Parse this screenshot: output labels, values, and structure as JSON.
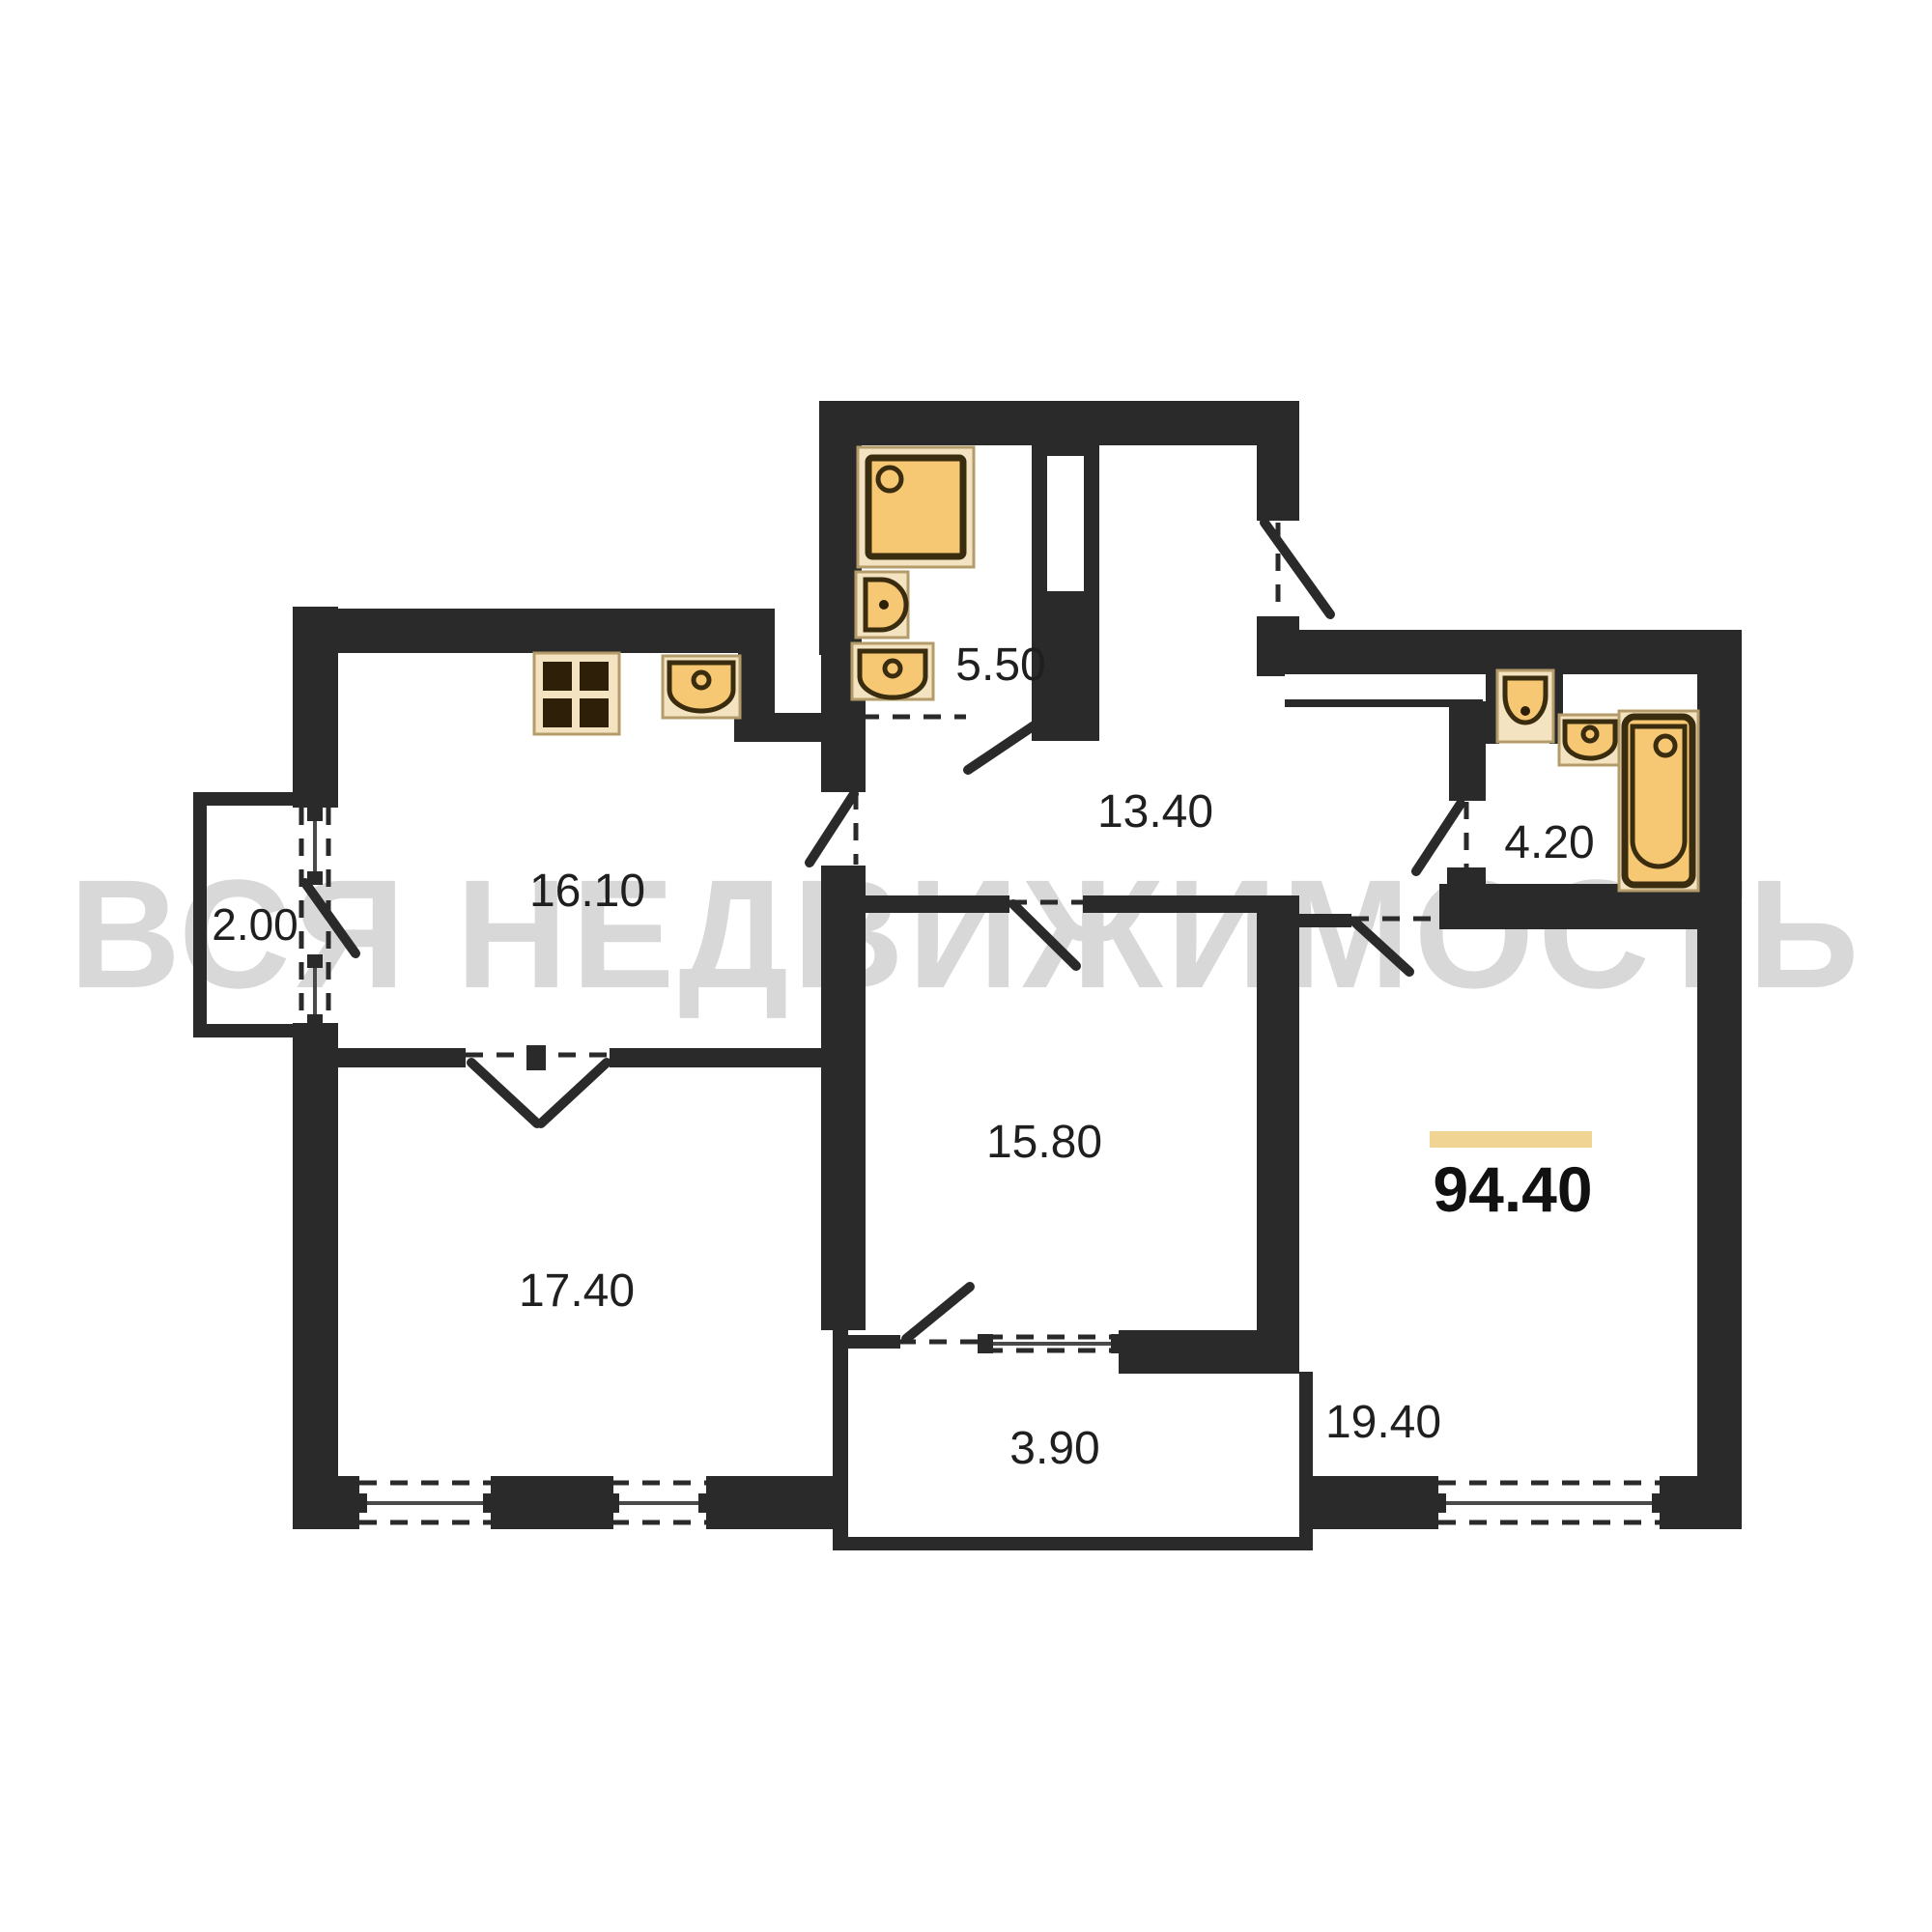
{
  "watermark": {
    "text": "ВСЯ НЕДВИЖИМОСТЬ",
    "color": "#d8d8d8"
  },
  "total": {
    "area": "94.40",
    "underline_color": "#f0d494"
  },
  "rooms": [
    {
      "name": "balcony-left",
      "area": "2.00"
    },
    {
      "name": "kitchen",
      "area": "16.10"
    },
    {
      "name": "bathroom-top",
      "area": "5.50"
    },
    {
      "name": "hallway",
      "area": "13.40"
    },
    {
      "name": "bathroom-right",
      "area": "4.20"
    },
    {
      "name": "room-bottom-left",
      "area": "17.40"
    },
    {
      "name": "room-middle",
      "area": "15.80"
    },
    {
      "name": "loggia-bottom",
      "area": "3.90"
    },
    {
      "name": "room-bottom-right",
      "area": "19.40"
    }
  ],
  "fixtures": [
    "shower-tray",
    "toilet",
    "wash-basin",
    "kitchen-sink",
    "stove",
    "toilet",
    "wash-basin",
    "bathtub"
  ],
  "colors": {
    "wall": "#2a2a2a",
    "fixture_fill": "#f7c873",
    "fixture_plate": "#f4e3c0",
    "fixture_outline": "#3a2c0f",
    "floor": "#ffffff"
  }
}
